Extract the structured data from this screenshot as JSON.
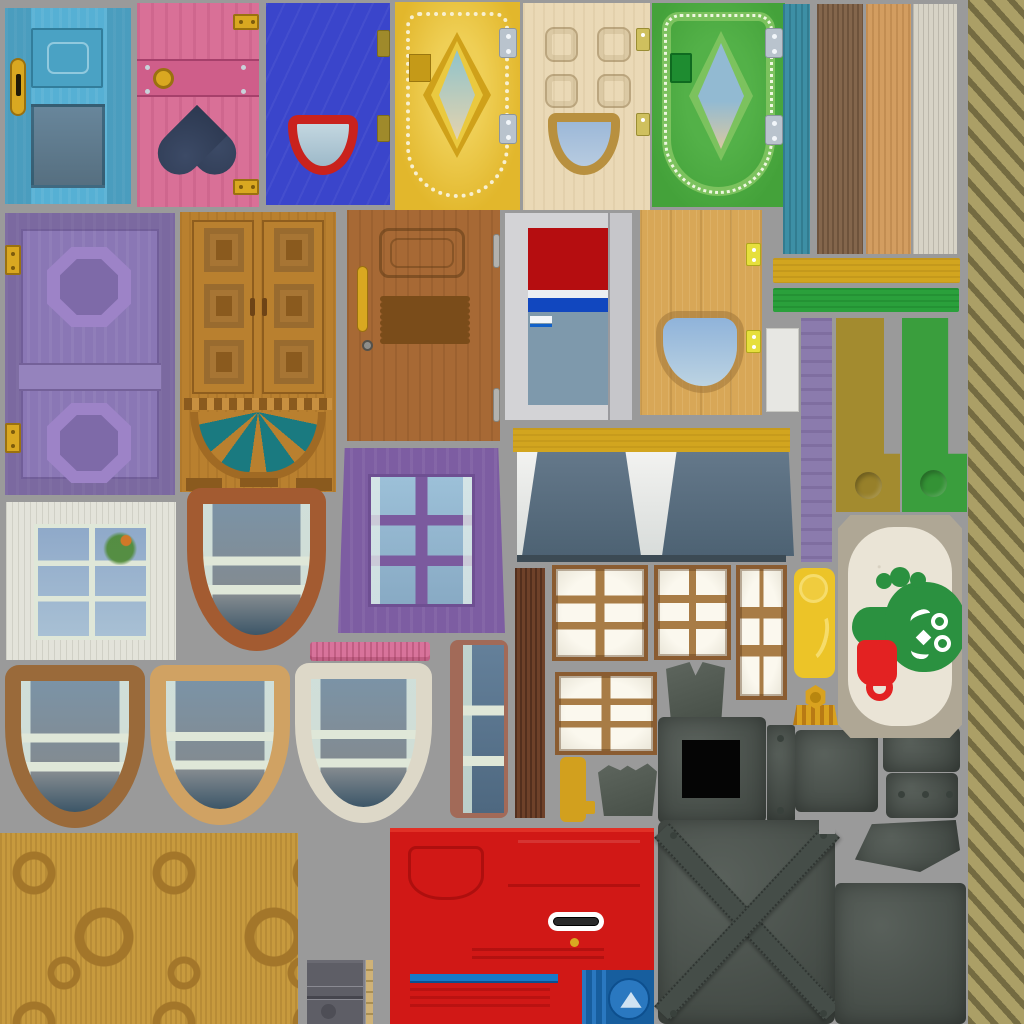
{
  "title": "door-and-window-texture-atlas",
  "palette": {
    "bg": "#9a9a9a",
    "gold": "#d9a821",
    "gold-deep": "#b8860f",
    "silver": "#b9c3cd",
    "blue-door": "#56b0d4",
    "blue-door-deep": "#4aa2c4",
    "slate-glass": "#5d7c92",
    "pink-door": "#d97097",
    "pink-band": "#cf5e8a",
    "heart": "#2c3850",
    "royal": "#3a45cb",
    "red-rim": "#c9221d",
    "pale-glass": "#aac7d6",
    "gold-door": "#e2b72c",
    "diamond-top": "#8fc3cb",
    "diamond-bot": "#e4d3ae",
    "cream": "#ead9b6",
    "green-door": "#44a23a",
    "green-band": "#7cc25e",
    "green-deep": "#1e8c30",
    "teal-plank": "#3d8fa5",
    "brown-plank": "#84664c",
    "tan-plank": "#d39d60",
    "white-plank": "#d7d3c6",
    "khaki": "#ab9f66",
    "khaki-dark": "#746b41",
    "purple-door": "#8a77b5",
    "purple-hi": "#9d83c7",
    "amber": "#b9802f",
    "amber-dark": "#8a5a1e",
    "teal-glass": "#1a7a80",
    "walnut": "#a76935",
    "pane-olive": "#5d604f",
    "frame-gray": "#d3d3d6",
    "red-top": "#b50d10",
    "stripe-blue": "#1147bf",
    "slate-panel": "#7e99ac",
    "oak": "#d8a757",
    "hinge-yel": "#e6df3c",
    "bar-yellow": "#d2a51f",
    "bar-green": "#2aa03b",
    "olive": "#a38b2f",
    "strip-green": "#3a9e3d",
    "strip-purple": "#8b7bad",
    "white-strip": "#e7e7e3",
    "awning": "#5d7181",
    "awning-dark": "#3c4a54",
    "white-frame": "#e3e3da",
    "mullion": "#dfe7d8",
    "glass-top": "#8fa9c9",
    "glass-bot": "#a8c0d4",
    "shield": "#a35b31",
    "purple-win": "#7d5da2",
    "purple-mull": "#7b5a9e",
    "pink-bar": "#d8739b",
    "mauve": "#a26a58",
    "dark-plank": "#6e4129",
    "shoji": "#8a5c31",
    "shoji-rail": "#a87c46",
    "shoji-pane": "#f2efe5",
    "metal": "#4b534d",
    "metal-dark": "#39413c",
    "face-border": "#afa795",
    "face-bg": "#eae4d6",
    "face-green": "#2b9140",
    "cup": "#e32222",
    "floor": "#c79a3e",
    "swirl": "#a3762a",
    "red-panel": "#d11816",
    "blue-box": "#175e9e",
    "blue-box-hi": "#2a78c0",
    "locker": "#5e5e66",
    "lamp": "#ecc428",
    "bamboo": "#cfb277",
    "bamboo-dark": "#a98e52"
  },
  "sprites": [
    "door-blue-window",
    "door-pink-heart",
    "door-royal-blue",
    "door-gold-diamond",
    "door-cream-squares",
    "door-green-diamond",
    "plank-teal",
    "plank-brown",
    "plank-tan",
    "plank-white",
    "texture-diagonal-khaki",
    "door-purple-octagons",
    "door-brown-fanlight",
    "door-walnut-eight-pane",
    "door-white-red-panel",
    "door-oak-porthole",
    "bar-yellow",
    "bar-green",
    "strip-white",
    "strip-purple",
    "bracket-olive",
    "bracket-green",
    "awning-panel",
    "window-white-six-pane",
    "window-brown-shield",
    "window-purple-six-pane",
    "bar-pink",
    "window-narrow-blue",
    "plank-dark-brown",
    "shutter-shoji-large",
    "shutter-shoji-medium",
    "shutter-shoji-tall",
    "shutter-shoji-wide",
    "bracket-yellow-small",
    "scrap-gray-small",
    "scrap-gray-notched",
    "panel-metal-black-square",
    "strip-metal-riveted",
    "panel-metal-plain",
    "panel-metal-top-right",
    "panel-metal-three-rivets",
    "panel-metal-skewed",
    "door-metal-cross-brace",
    "panel-metal-large",
    "lamp-yellow",
    "finial-gold",
    "plaque-green-face",
    "window-arch-brown",
    "window-arch-tan",
    "window-arch-white",
    "floor-swirl-wood",
    "cabinet-gray-small",
    "strip-bamboo",
    "door-red-utility"
  ]
}
